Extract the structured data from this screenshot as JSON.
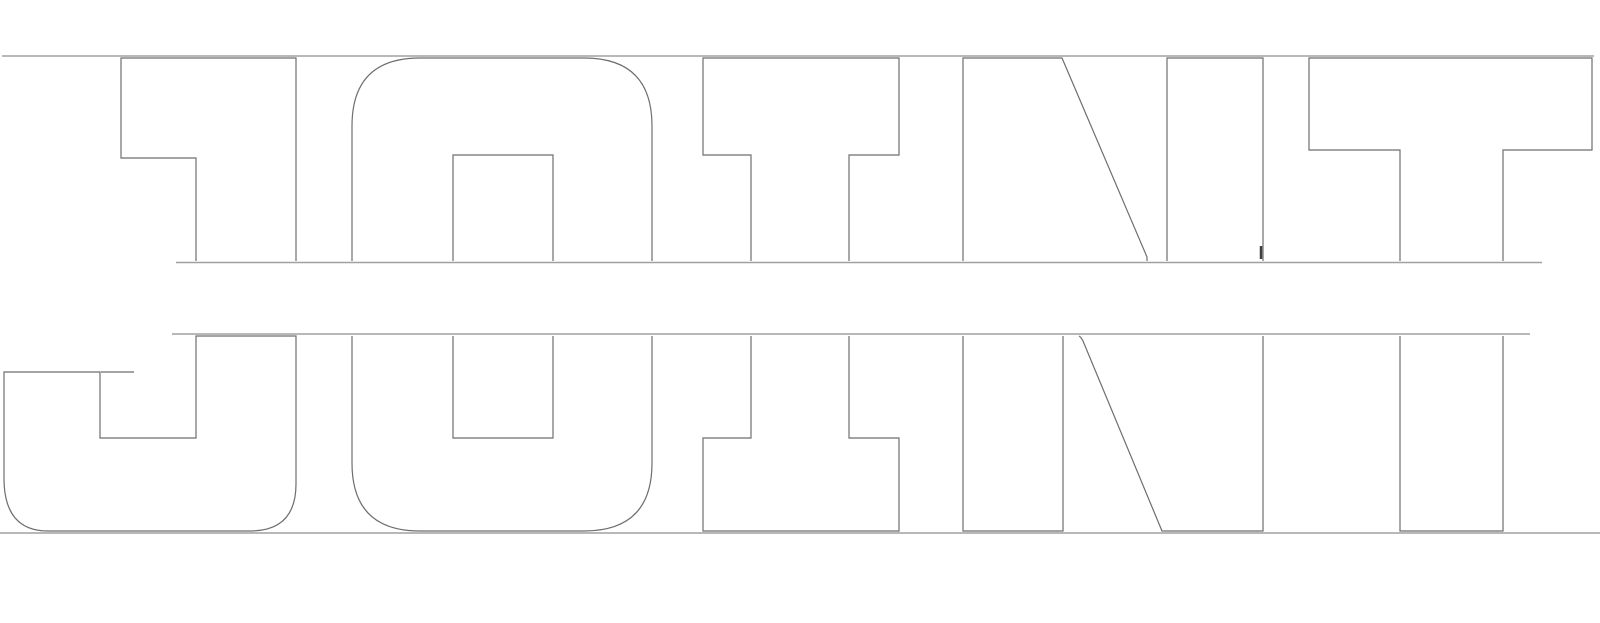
{
  "meta": {
    "description": "Split outlined wordmark: the word JOINT cut horizontally into a top half and a bottom half, separated by a gap, with thin horizontal guide rules at cap height, both cut lines, and the baseline.",
    "background": "#ffffff"
  },
  "word": {
    "text": "JOINT",
    "letters": [
      "J",
      "O",
      "I",
      "N",
      "T"
    ],
    "rows": [
      "top-half",
      "bottom-half"
    ]
  },
  "rules": {
    "count": 4,
    "names": [
      "cap-line",
      "top-cut-line",
      "bottom-cut-line",
      "base-line"
    ]
  },
  "colors": {
    "background": "#ffffff",
    "letter_stroke": "#6e6e6e",
    "rule_stroke": "#a0a0a0",
    "artifact": "#3f3f3f"
  }
}
